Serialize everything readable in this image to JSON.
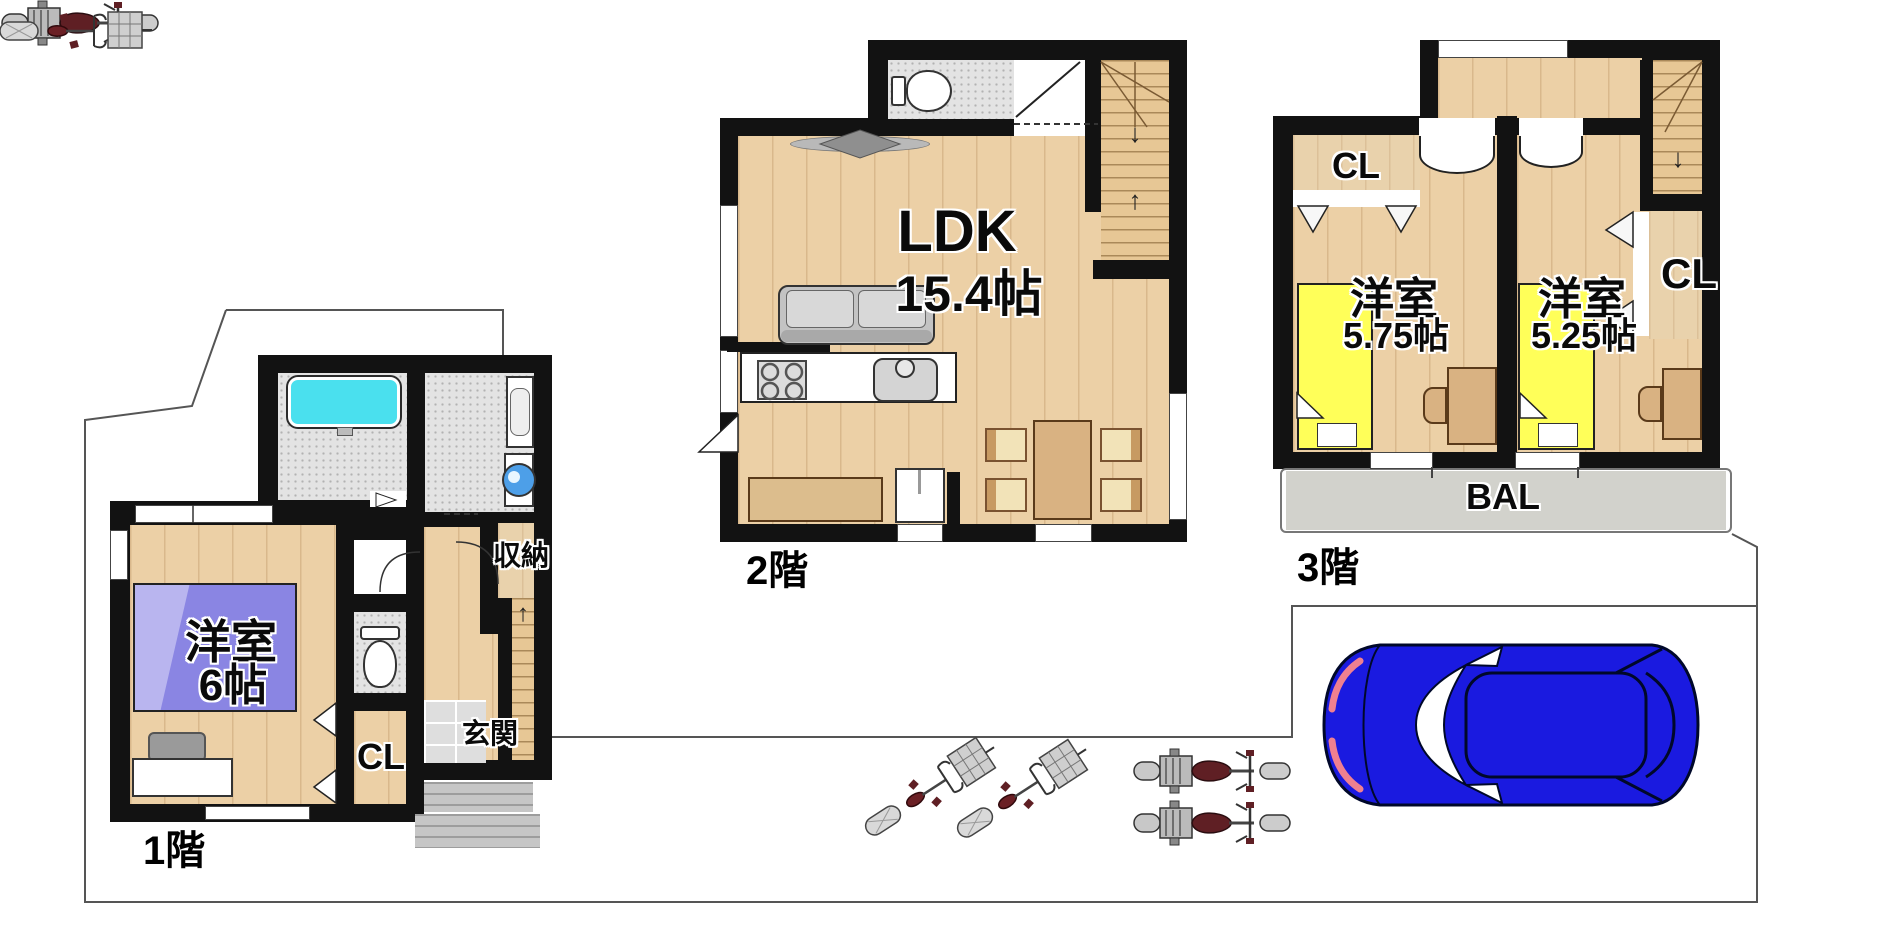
{
  "page": {
    "type": "property-floor-plan",
    "background": "#ffffff"
  },
  "floor1": {
    "label": "1階",
    "room_name": "洋室",
    "room_size": "6帖",
    "closet": "CL",
    "entrance": "玄関",
    "storage": "収納"
  },
  "floor2": {
    "label": "2階",
    "room_name": "LDK",
    "room_size": "15.4帖"
  },
  "floor3": {
    "label": "3階",
    "room_a_name": "洋室",
    "room_a_size": "5.75帖",
    "room_b_name": "洋室",
    "room_b_size": "5.25帖",
    "closet_a": "CL",
    "closet_b": "CL",
    "balcony": "BAL"
  },
  "icons": {
    "stair_up_arrow": "↑",
    "stair_down_arrow": "↓"
  },
  "colors": {
    "wall": "#121212",
    "wood_floor": "#ecd0a6",
    "bed_purple": "#8a85e3",
    "bed_yellow": "#ffff59",
    "bathtub_cyan": "#4ae0ee",
    "balcony_gray": "#d2d2cc",
    "car_blue": "#1a1ae0",
    "furniture_tan": "#d9b282",
    "chair_cream": "#f2e3b8",
    "vehicle_seat_red": "#5f1f24",
    "boundary_line": "#555555"
  }
}
